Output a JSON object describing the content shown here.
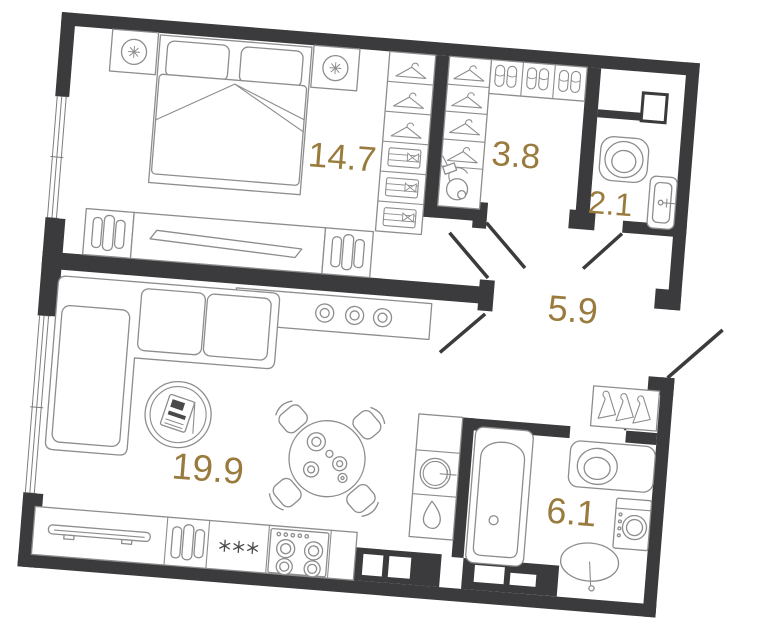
{
  "plan": {
    "type": "apartment-floor-plan",
    "rotation_deg": 4.6,
    "colors": {
      "walls": "#3b3b3d",
      "furniture_lines": "#8d8d8d",
      "area_labels": "#9a7b3e",
      "floor": "#ffffff"
    },
    "rooms": [
      {
        "id": "bedroom",
        "area": "14.7",
        "furniture": [
          "double-bed",
          "pillows",
          "nightstand-left",
          "nightstand-right",
          "table-lamp",
          "wardrobe-hangers",
          "folded-clothes-shelves",
          "tv-stand",
          "tv",
          "media-cabinet-books"
        ]
      },
      {
        "id": "dressing-room",
        "area": "3.8",
        "furniture": [
          "hanger-rail",
          "slipper-shelf",
          "vacuum-cleaner"
        ]
      },
      {
        "id": "wc-laundry",
        "area": "2.1",
        "furniture": [
          "toilet",
          "wash-basin",
          "vent-duct"
        ]
      },
      {
        "id": "hallway",
        "area": "5.9",
        "furniture": [
          "coat-rack",
          "door-swings",
          "entry-door"
        ]
      },
      {
        "id": "living-kitchen",
        "area": "19.9",
        "furniture": [
          "corner-sofa",
          "round-rug-magazine-stand",
          "dining-table",
          "four-chairs",
          "sideboard-knobs",
          "kitchen-counter",
          "round-sink",
          "kettle",
          "dish-drainer",
          "books",
          "fridge-freezer",
          "stove-4-burners"
        ]
      },
      {
        "id": "bathroom",
        "area": "6.1",
        "furniture": [
          "bathtub",
          "toilet",
          "washing-machine",
          "oval-sink",
          "vent-ducts"
        ]
      }
    ],
    "icons": {
      "freezer_symbol": "three asterisk stars",
      "hanger": "clothes hanger top view",
      "side_hanger": "clothes hanger side view",
      "slippers": "pair of slippers",
      "lamp": "bedside lamp with star shade"
    }
  }
}
